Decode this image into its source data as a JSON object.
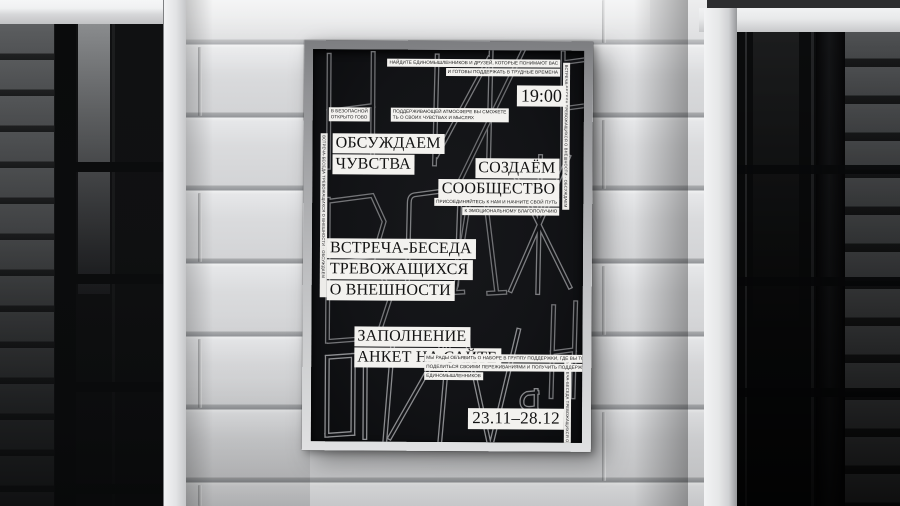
{
  "poster": {
    "top_note_line1": "НАЙДИТЕ ЕДИНОМЫШЛЕННИКОВ И ДРУЗЕЙ, КОТОРЫЕ ПОНИМАЮТ ВАС",
    "top_note_line2": "И ГОТОВЫ ПОДДЕРЖАТЬ В ТРУДНЫЕ ВРЕМЕНА",
    "time": "19:00",
    "safe_chip1_line1": "В БЕЗОПАСНОЙ",
    "safe_chip1_line2": "ОТКРЫТО ГОВО",
    "safe_chip2_line1": "ПОДДЕРЖИВАЮЩЕЙ АТМОСФЕРЕ ВЫ СМОЖЕТЕ",
    "safe_chip2_line2": "ТЬ О СВОИХ ЧУВСТВАХ И МЫСЛЯХ",
    "headline_discuss_line1": "ОБСУЖДАЕМ",
    "headline_discuss_line2": "ЧУВСТВА",
    "headline_community_line1": "СОЗДАЁМ",
    "headline_community_line2": "СООБЩЕСТВО",
    "join_note_line1": "ПРИСОЕДИНЯЙТЕСЬ К НАМ И НАЧНИТЕ СВОЙ ПУТЬ",
    "join_note_line2": "К ЭМОЦИОНАЛЬНОМУ БЛАГОПОЛУЧИЮ",
    "headline_meeting_line1": "ВСТРЕЧА-БЕСЕДА",
    "headline_meeting_line2": "ТРЕВОЖАЩИХСЯ",
    "headline_meeting_line3": "О ВНЕШНОСТИ",
    "headline_form_line1": "ЗАПОЛНЕНИЕ",
    "headline_form_line2": "АНКЕТ НА САЙТЕ",
    "recruit_line1": "МЫ РАДЫ ОБЪЯВИТЬ О НАБОРЕ В ГРУППУ ПОДДЕРЖКИ, ГДЕ ВЫ ТОЧНО СМОЖЕТЕ",
    "recruit_line2": "ПОДЕЛИТЬСЯ СВОИМИ ПЕРЕЖИВАНИЯМИ И ПОЛУЧИТЬ ПОДДЕРЖКУ ОТ",
    "recruit_line3": "ЕДИНОМЫШЛЕННИКОВ",
    "dates": "23.11–28.12",
    "edge_microtext": "ВСТРЕЧА-БЕСЕДА ТРЕВОЖАЩИХСЯ О ВНЕШНОСТИ · ОБСУЖДАЕМ ЧУВСТВА · СОЗДАЁМ СООБЩЕСТВО · ЗАПОЛНЕНИЕ АНКЕТ НА САЙТЕ · 23.11–28.12 · 19:00",
    "background_letters": [
      "Ч",
      "И",
      "Е",
      "В",
      "О",
      "Д",
      "Ж",
      "Ы",
      "И",
      "И",
      "Я",
      "Н"
    ]
  },
  "colors": {
    "poster_background": "#121316",
    "paper_chip": "#f3f2ef",
    "chip_text": "#141414",
    "letterform_gray": "#7d7e81",
    "wall_gray": "#d6d7d9",
    "frame_silver": "#c2c3c5"
  }
}
